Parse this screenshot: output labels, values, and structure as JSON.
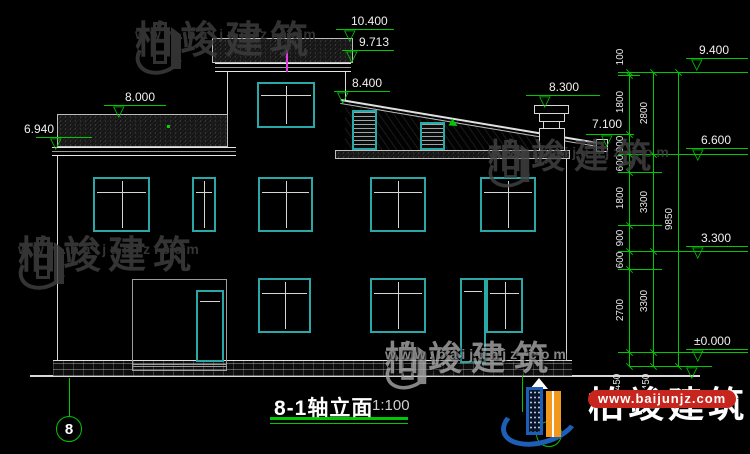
{
  "meta": {
    "drawing_type": "house elevation CAD drawing"
  },
  "title": {
    "text": "8-1轴立面",
    "scale": "1:100"
  },
  "axis": {
    "start_bubble": "8"
  },
  "watermark": {
    "brand": "柏竣建筑",
    "url": "www.baijunjz.com"
  },
  "colors": {
    "dim_green": "#00c800",
    "cad_cyan": "#2aa7a7",
    "vent_magenta": "#e43ae4",
    "line_white": "#d8d8d8",
    "wm_dark": "#3f3f3f",
    "wm_light": "#a8a8a8",
    "logo_blue": "#1d5fb8",
    "logo_orange": "#f2991d",
    "logo_red": "#c6261e"
  },
  "elevation_markers": [
    {
      "label": "10.400",
      "lx": 351,
      "ly": 15,
      "x1": 336,
      "x2": 394,
      "y": 29,
      "tx": 352
    },
    {
      "label": "9.713",
      "lx": 359,
      "ly": 36,
      "x1": 342,
      "x2": 394,
      "y": 50,
      "tx": 354
    },
    {
      "label": "8.400",
      "lx": 352,
      "ly": 77,
      "x1": 334,
      "x2": 390,
      "y": 91,
      "tx": 345
    },
    {
      "label": "8.300",
      "lx": 549,
      "ly": 81,
      "x1": 526,
      "x2": 600,
      "y": 95,
      "tx": 547
    },
    {
      "label": "8.000",
      "lx": 125,
      "ly": 91,
      "x1": 104,
      "x2": 166,
      "y": 105,
      "tx": 121
    },
    {
      "label": "6.940",
      "lx": 24,
      "ly": 123,
      "x1": 36,
      "x2": 92,
      "y": 137,
      "tx": 58
    },
    {
      "label": "7.100",
      "lx": 592,
      "ly": 118,
      "x1": 586,
      "x2": 634,
      "y": 134,
      "tx": 609
    },
    {
      "label": "9.400",
      "lx": 699,
      "ly": 44,
      "x1": 686,
      "x2": 748,
      "y": 58,
      "tx": 699
    },
    {
      "label": "6.600",
      "lx": 701,
      "ly": 134,
      "x1": 686,
      "x2": 748,
      "y": 148,
      "tx": 700
    },
    {
      "label": "3.300",
      "lx": 701,
      "ly": 232,
      "x1": 686,
      "x2": 748,
      "y": 246,
      "tx": 700
    },
    {
      "label": "±0.000",
      "lx": 694,
      "ly": 335,
      "x1": 686,
      "x2": 748,
      "y": 349,
      "tx": 700
    },
    {
      "label": "",
      "lx": 0,
      "ly": 0,
      "x1": 652,
      "x2": 710,
      "y": 366,
      "tx": 694
    }
  ],
  "dim_chains": {
    "inner_labels": [
      "100",
      "1800",
      "900",
      "600",
      "1800",
      "900",
      "600",
      "2700",
      "450"
    ],
    "middle_labels": [
      "2800",
      "3300",
      "3300",
      "450"
    ],
    "outer_labels": [
      "9850"
    ]
  },
  "dim_label_pos": [
    {
      "t": "100",
      "x": 621,
      "y": 57
    },
    {
      "t": "1800",
      "x": 621,
      "y": 102
    },
    {
      "t": "900",
      "x": 621,
      "y": 144
    },
    {
      "t": "600",
      "x": 621,
      "y": 163
    },
    {
      "t": "1800",
      "x": 621,
      "y": 198
    },
    {
      "t": "900",
      "x": 621,
      "y": 238
    },
    {
      "t": "600",
      "x": 621,
      "y": 260
    },
    {
      "t": "2700",
      "x": 621,
      "y": 310
    },
    {
      "t": "450",
      "x": 618,
      "y": 382
    },
    {
      "t": "2800",
      "x": 645,
      "y": 113
    },
    {
      "t": "3300",
      "x": 645,
      "y": 202
    },
    {
      "t": "3300",
      "x": 645,
      "y": 301
    },
    {
      "t": "450",
      "x": 647,
      "y": 382
    },
    {
      "t": "9850",
      "x": 670,
      "y": 219
    }
  ],
  "geometry": {
    "hlines": [
      [
        618,
        748,
        72
      ],
      [
        618,
        640,
        75
      ],
      [
        618,
        748,
        154
      ],
      [
        618,
        662,
        172
      ],
      [
        618,
        662,
        225
      ],
      [
        618,
        748,
        251
      ],
      [
        618,
        662,
        269
      ],
      [
        618,
        748,
        352
      ],
      [
        630,
        712,
        366
      ]
    ],
    "vlines": [
      [
        629,
        72,
        366
      ],
      [
        653,
        72,
        366
      ],
      [
        678,
        72,
        366
      ],
      [
        69,
        378,
        416
      ],
      [
        522,
        376,
        412
      ]
    ],
    "ticks": [
      {
        "x": 629,
        "ys": [
          72,
          75,
          134,
          154,
          172,
          225,
          251,
          269,
          352,
          366
        ]
      },
      {
        "x": 653,
        "ys": [
          72,
          154,
          251,
          352,
          366
        ]
      },
      {
        "x": 678,
        "ys": [
          72,
          366
        ]
      }
    ]
  },
  "openings": [
    {
      "x": 93,
      "y": 177,
      "w": 57,
      "h": 55,
      "type": "window"
    },
    {
      "x": 192,
      "y": 177,
      "w": 24,
      "h": 55,
      "type": "window"
    },
    {
      "x": 258,
      "y": 177,
      "w": 55,
      "h": 55,
      "type": "window"
    },
    {
      "x": 370,
      "y": 177,
      "w": 56,
      "h": 55,
      "type": "window"
    },
    {
      "x": 480,
      "y": 177,
      "w": 56,
      "h": 55,
      "type": "window"
    },
    {
      "x": 257,
      "y": 82,
      "w": 58,
      "h": 46,
      "type": "window"
    },
    {
      "x": 258,
      "y": 278,
      "w": 53,
      "h": 55,
      "type": "window"
    },
    {
      "x": 370,
      "y": 278,
      "w": 56,
      "h": 55,
      "type": "window"
    },
    {
      "x": 486,
      "y": 278,
      "w": 37,
      "h": 55,
      "type": "window"
    },
    {
      "x": 196,
      "y": 290,
      "w": 28,
      "h": 72,
      "type": "door"
    },
    {
      "x": 460,
      "y": 278,
      "w": 26,
      "h": 85,
      "type": "door"
    },
    {
      "x": 352,
      "y": 110,
      "w": 25,
      "h": 40,
      "type": "louver"
    },
    {
      "x": 420,
      "y": 122,
      "w": 25,
      "h": 28,
      "type": "louver"
    }
  ]
}
